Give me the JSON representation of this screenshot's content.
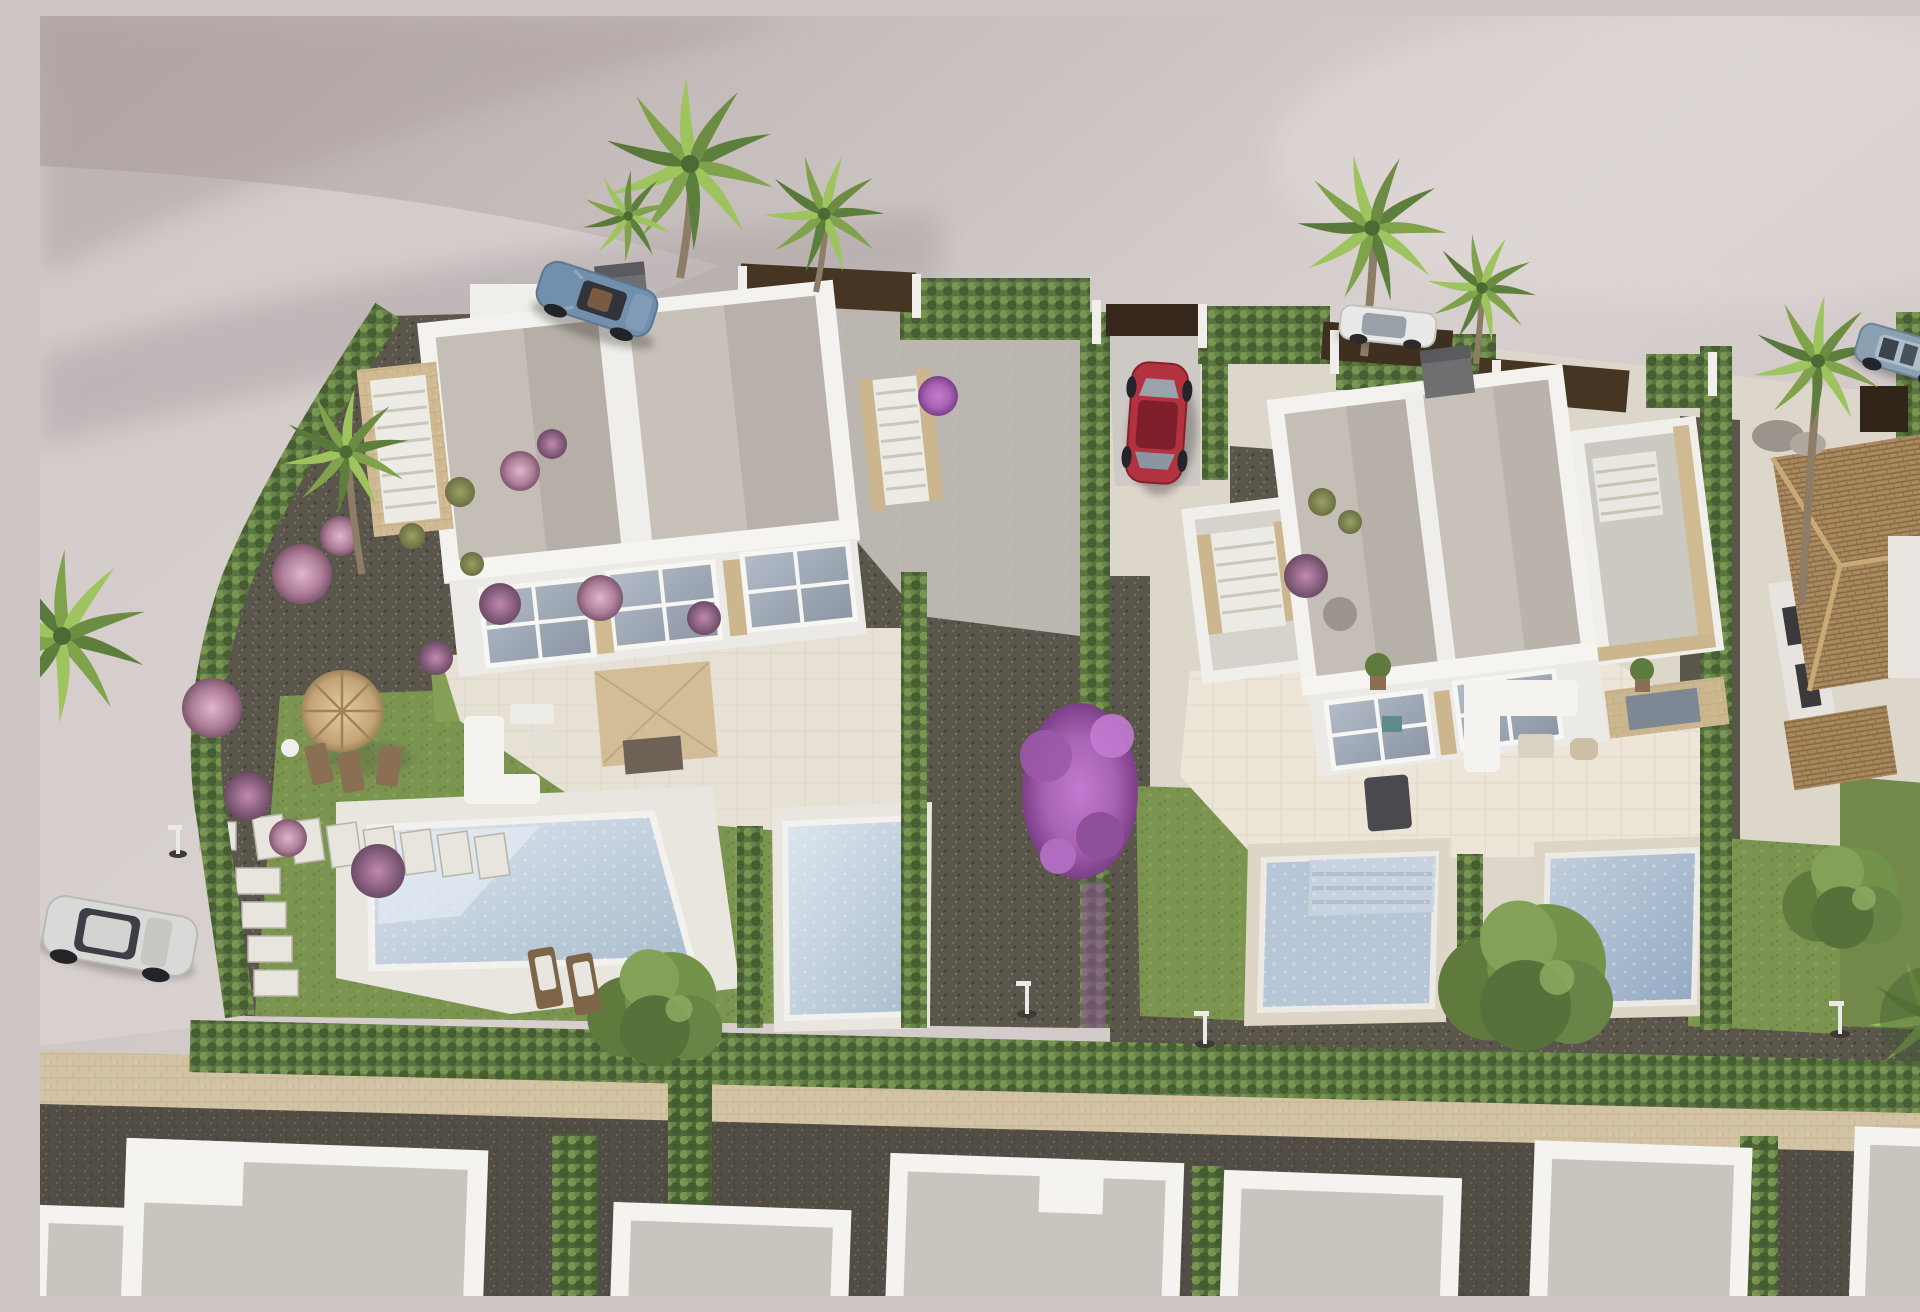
{
  "meta": {
    "description": "Aerial 3D architect render of a modern villa development: two white duplex villas with flat grey roofs, private pools, lawns, cypress hedges, palm trees, parked cars and neighbouring houses",
    "canvas": {
      "width": 1920,
      "height": 1280
    }
  },
  "palette": {
    "pavement": "#cfc7c5",
    "pavement_light": "#dad3d1",
    "pavement_dark": "#b2a7a5",
    "road_light": "#d9d3d1",
    "gravel": "#5b564c",
    "gravel_light": "#6e685c",
    "sand_path": "#d2c3a4",
    "asphalt": "#514c44",
    "lawn": "#7b9550",
    "lawn_dark": "#66803e",
    "hedge": "#5a7440",
    "hedge_light": "#7f9d54",
    "wall_white": "#f3f2ef",
    "wall_shadow": "#d9d5d0",
    "roof_grey": "#c4beb7",
    "roof_shadow": "#a59e97",
    "stone_tan": "#cfba92",
    "terrace": "#e7e0d4",
    "pool_water": "#b7c6d6",
    "pool_light": "#dde6ee",
    "pool_deep": "#93a9c2",
    "fence_brown": "#473524",
    "gate_dark": "#32261a",
    "tile_roof": "#aa8a60",
    "chimney_grey": "#6f6f72",
    "trunk": "#8d7c66",
    "tree_green": "#74934a",
    "palm_dark": "#3f5a2e",
    "purple_bloom": "#9b59a8",
    "pink_bloom": "#c795ad",
    "car_convertible_blue": "#7290ae",
    "car_red": "#b23240",
    "car_estate_white": "#e9e9e7",
    "car_suv_blue": "#8ba0b2",
    "car_hatch_white": "#d9d9d7",
    "lamp_white": "#eceae6"
  },
  "scene": {
    "ground": {
      "label": "sunlit pavement with curved access road"
    },
    "villas": [
      {
        "name": "left-duplex-villa",
        "walls": "white",
        "roof": "flat grey with white parapets",
        "features": [
          "roof stairs left",
          "roof stairs right",
          "grey chimney",
          "glazed facade",
          "beige terrace"
        ]
      },
      {
        "name": "right-duplex-villa",
        "walls": "white",
        "roof": "flat grey with white parapets",
        "features": [
          "garage stair wing",
          "timber roof-deck balustrade",
          "grey chimney",
          "glazed facade"
        ]
      }
    ],
    "pools": [
      {
        "name": "left-garden-main-pool",
        "shape": "wide trapezoid",
        "water": "pale blue"
      },
      {
        "name": "left-garden-second-pool",
        "shape": "narrow rectangle",
        "water": "pale blue"
      },
      {
        "name": "right-garden-step-pool",
        "shape": "rectangle with steps",
        "water": "grey blue"
      },
      {
        "name": "right-garden-blue-pool",
        "shape": "rectangle",
        "water": "deeper blue"
      }
    ],
    "vehicles": [
      {
        "name": "blue-convertible",
        "location": "top-left road"
      },
      {
        "name": "red-hatchback",
        "location": "centre driveway"
      },
      {
        "name": "white-estate",
        "location": "behind top palms"
      },
      {
        "name": "silver-suv",
        "location": "top-right drive"
      },
      {
        "name": "white-hatchback",
        "location": "bottom-left road"
      }
    ],
    "vegetation": {
      "palm_groups": 6,
      "deciduous_trees": 3,
      "bougainvillea": "purple, against central hedge",
      "flower_bushes": "pink and mauve balls on dark gravel",
      "hedges": "clipped cypress rows around every plot"
    },
    "furniture": [
      "straw parasol with loungers",
      "square cream parasol with dining set",
      "white lounge sofas",
      "sun loungers by pool",
      "barbecue"
    ],
    "neighborhood": [
      "terracotta tiled house on the right",
      "row of white flat-roof houses along bottom street",
      "street lamps"
    ]
  }
}
